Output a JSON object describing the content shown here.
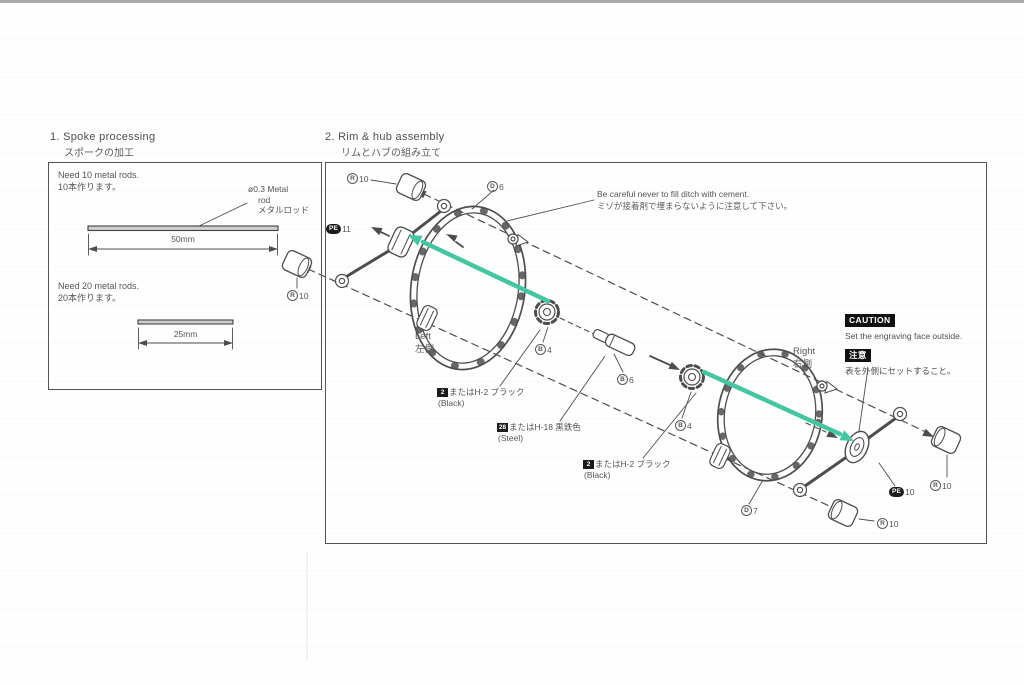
{
  "section1": {
    "title": "1. Spoke processing",
    "title_jp": "スポークの加工",
    "need10": "Need 10 metal rods.",
    "need10_jp": "10本作ります。",
    "rod_note_line1": "ø0.3 Metal",
    "rod_note_line2": "rod",
    "rod_note_line3": "メタルロッド",
    "dim_long": "50mm",
    "need20": "Need 20 metal rods.",
    "need20_jp": "20本作ります。",
    "dim_short": "25mm"
  },
  "section2": {
    "title": "2. Rim & hub assembly",
    "title_jp": "リムとハブの組み立て",
    "cement_note_en": "Be careful never to fill ditch with cement.",
    "cement_note_jp": "ミゾが接着剤で埋まらないように注意して下さい。",
    "caution_badge": "CAUTION",
    "caution_text_en": "Set the engraving face outside.",
    "caution_badge_jp": "注意",
    "caution_text_jp": "表を外側にセットすること。",
    "left_en": "Left",
    "left_jp": "左側",
    "right_en": "Right",
    "right_jp": "右側"
  },
  "parts": {
    "r10_top_left": {
      "letter": "R",
      "number": "10"
    },
    "r10_mid_left": {
      "letter": "R",
      "number": "10"
    },
    "d6": {
      "letter": "D",
      "number": "6"
    },
    "pe11": {
      "badge": "PE",
      "number": "11"
    },
    "b4_left": {
      "letter": "B",
      "number": "4"
    },
    "b6": {
      "letter": "B",
      "number": "6"
    },
    "b4_right": {
      "letter": "B",
      "number": "4"
    },
    "d7": {
      "letter": "D",
      "number": "7"
    },
    "pe10": {
      "badge": "PE",
      "number": "10"
    },
    "r10_right_upper": {
      "letter": "R",
      "number": "10"
    },
    "r10_right_lower": {
      "letter": "R",
      "number": "10"
    }
  },
  "paint_notes": {
    "p1": {
      "badge": "2",
      "text": "またはH-2 ブラック",
      "sub": "(Black)"
    },
    "p2": {
      "badge": "28",
      "text": "またはH-18 黒鉄色",
      "sub": "(Steel)"
    },
    "p3": {
      "badge": "2",
      "text": "またはH-2 ブラック",
      "sub": "(Black)"
    }
  },
  "colors": {
    "arrow_green": "#45c5a1",
    "ink": "#4a4a4a"
  }
}
